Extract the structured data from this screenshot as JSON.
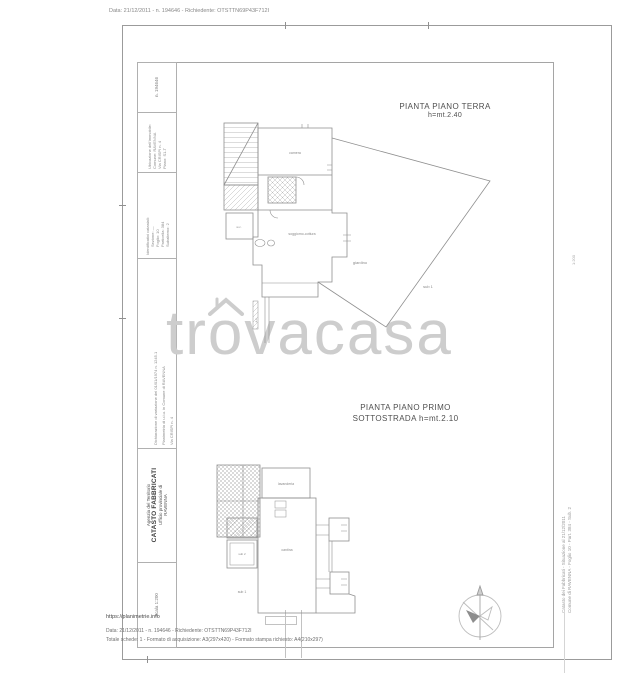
{
  "meta": {
    "top_line": "Data: 21/12/2011 - n. 194646 - Richiedente: OTSTTN69P43F712I",
    "footer_url": "https://planimetrie.info",
    "footer_line1": "Data: 21/12/2011 - n. 194646 - Richiedente: OTSTTN69P43F712I",
    "footer_line2": "Totale schede: 1 - Formato di acquisizione: A3(297x420) - Formato stampa richiesto: A4(210x297)"
  },
  "title_block": {
    "protocol": "n. 194646",
    "location": {
      "title": "Ubicazione dell'immobile:",
      "line1": "Comune: RAVENNA",
      "line2": "Via CRISPI n. 4",
      "line3": "Piano: S1-T"
    },
    "identifiers": {
      "title": "Identificativi catastali:",
      "line1": "Sezione: —",
      "line2": "Foglio: 10",
      "line3": "Particella: 384",
      "line4": "Subalterno: 2"
    },
    "declaration": {
      "line1": "Dichiarazione di variazione del 01/01/1974 n. 1245.1",
      "line2": "Planimetria di u.i.u. in Comune di RAVENNA",
      "line3": "Via CRISPI n. 4"
    },
    "agency": {
      "line1": "Agenzia del Territorio",
      "line2": "CATASTO FABBRICATI",
      "line3": "Ufficio provinciale di",
      "line4": "RAVENNA"
    },
    "scale": "Scala 1:200"
  },
  "plans": {
    "terra": {
      "title": "PIANTA PIANO TERRA",
      "height_note": "h=mt.2.40",
      "labels": {
        "camera": "camera",
        "soggiorno": "soggiorno-cottura",
        "wc": "w.c.",
        "garden": "giardino",
        "sub_garden": "sub 1",
        "duct": "a.c."
      }
    },
    "sottostrada": {
      "title_line1": "PIANTA PIANO PRIMO",
      "title_line2": "SOTTOSTRADA  h=mt.2.10",
      "labels": {
        "lavanderia": "lavanderia",
        "cantina": "cantina",
        "sub2": "sub 2",
        "sub1": "sub 1"
      }
    }
  },
  "watermark": {
    "pre": "tr",
    "o": "o",
    "post": "vacasa"
  },
  "right_margin": {
    "line1": "Catasto dei Fabbricati - Situazione al 21/12/2011",
    "line2": "Comune di RAVENNA - Foglio 10 - Part. 384 - Sub. 2",
    "scale_note": "1:200"
  },
  "colors": {
    "line_gray": "#8f8f8f",
    "frame_gray": "#9b9b9b",
    "watermark_gray": "#cdcdcd",
    "title_gray": "#4f4f4f"
  }
}
